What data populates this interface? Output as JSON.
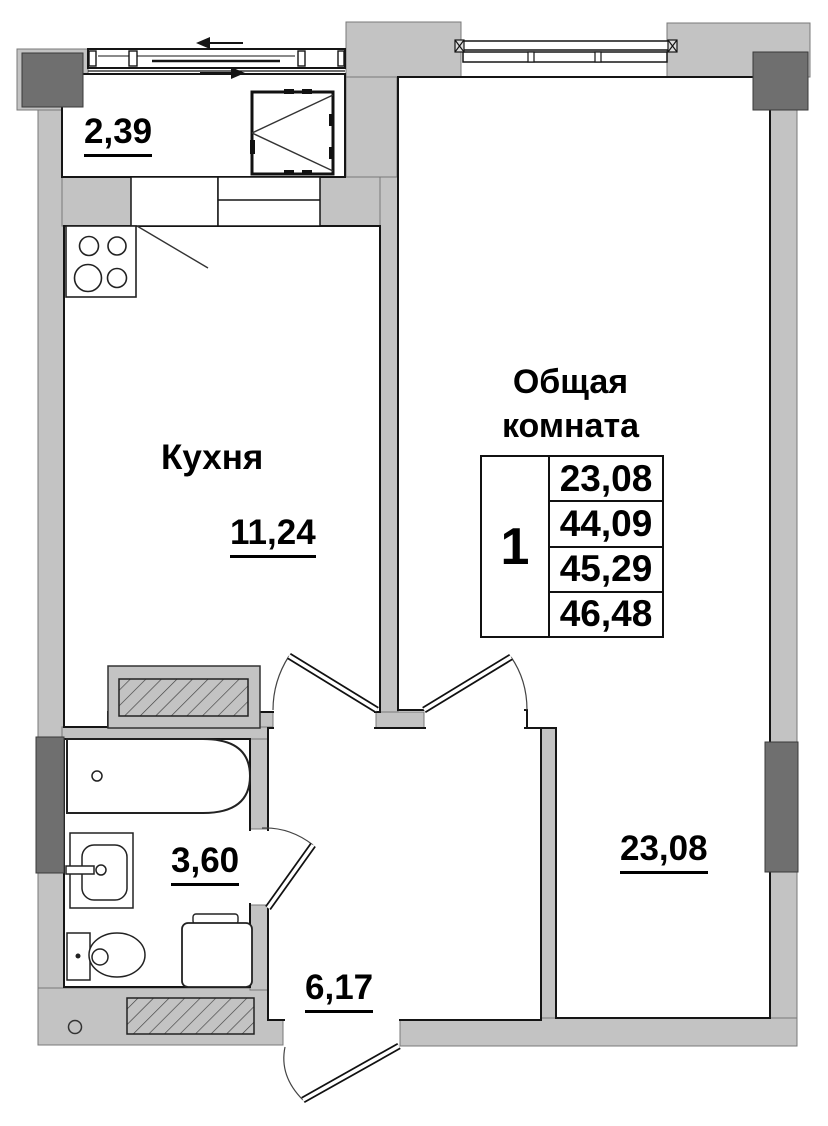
{
  "plan": {
    "rooms": {
      "balcony": {
        "area": "2,39"
      },
      "kitchen": {
        "name": "Кухня",
        "area": "11,24"
      },
      "bathroom": {
        "area": "3,60"
      },
      "hall": {
        "area": "6,17"
      },
      "living": {
        "name_line1": "Общая",
        "name_line2": "комната",
        "area": "23,08"
      }
    },
    "summary_table": {
      "unit": "1",
      "values": [
        "23,08",
        "44,09",
        "45,29",
        "46,48"
      ]
    },
    "colors": {
      "wall": "#c3c3c3",
      "column": "#6f6f6f",
      "line": "#151515"
    }
  }
}
